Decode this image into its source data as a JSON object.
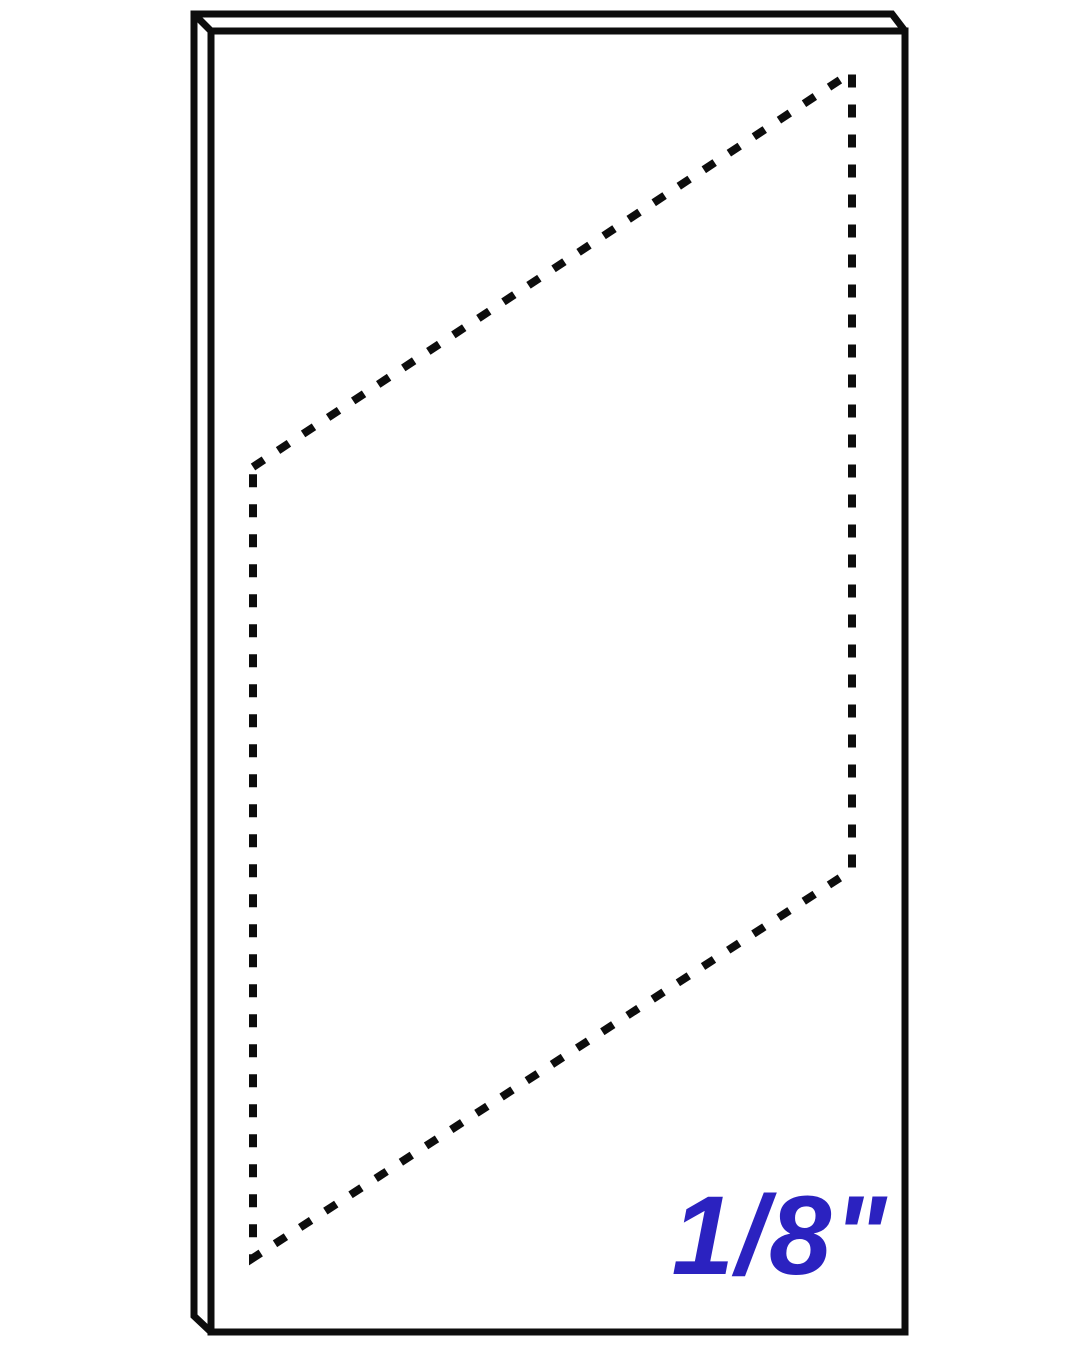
{
  "canvas": {
    "background": "#ffffff",
    "line_color": "#0d0d0d"
  },
  "diagram": {
    "panel": {
      "silhouette_path": "M194,14 L892,14 L905,31 L905,1332 L211,1332 L194,1316 Z",
      "front_face_path": "M211,31 L905,31 L905,1332 L211,1332 Z",
      "top_left_bevel_path": "M194,14 L211,31",
      "stroke_width": "7"
    },
    "cut_outline": {
      "path": "M253,467 L852,72 L852,870 L253,1258 Z",
      "stroke_width": "8",
      "dash_array": "13 17"
    },
    "label": {
      "text": "1/8\"",
      "color": "#2b22c0"
    }
  }
}
